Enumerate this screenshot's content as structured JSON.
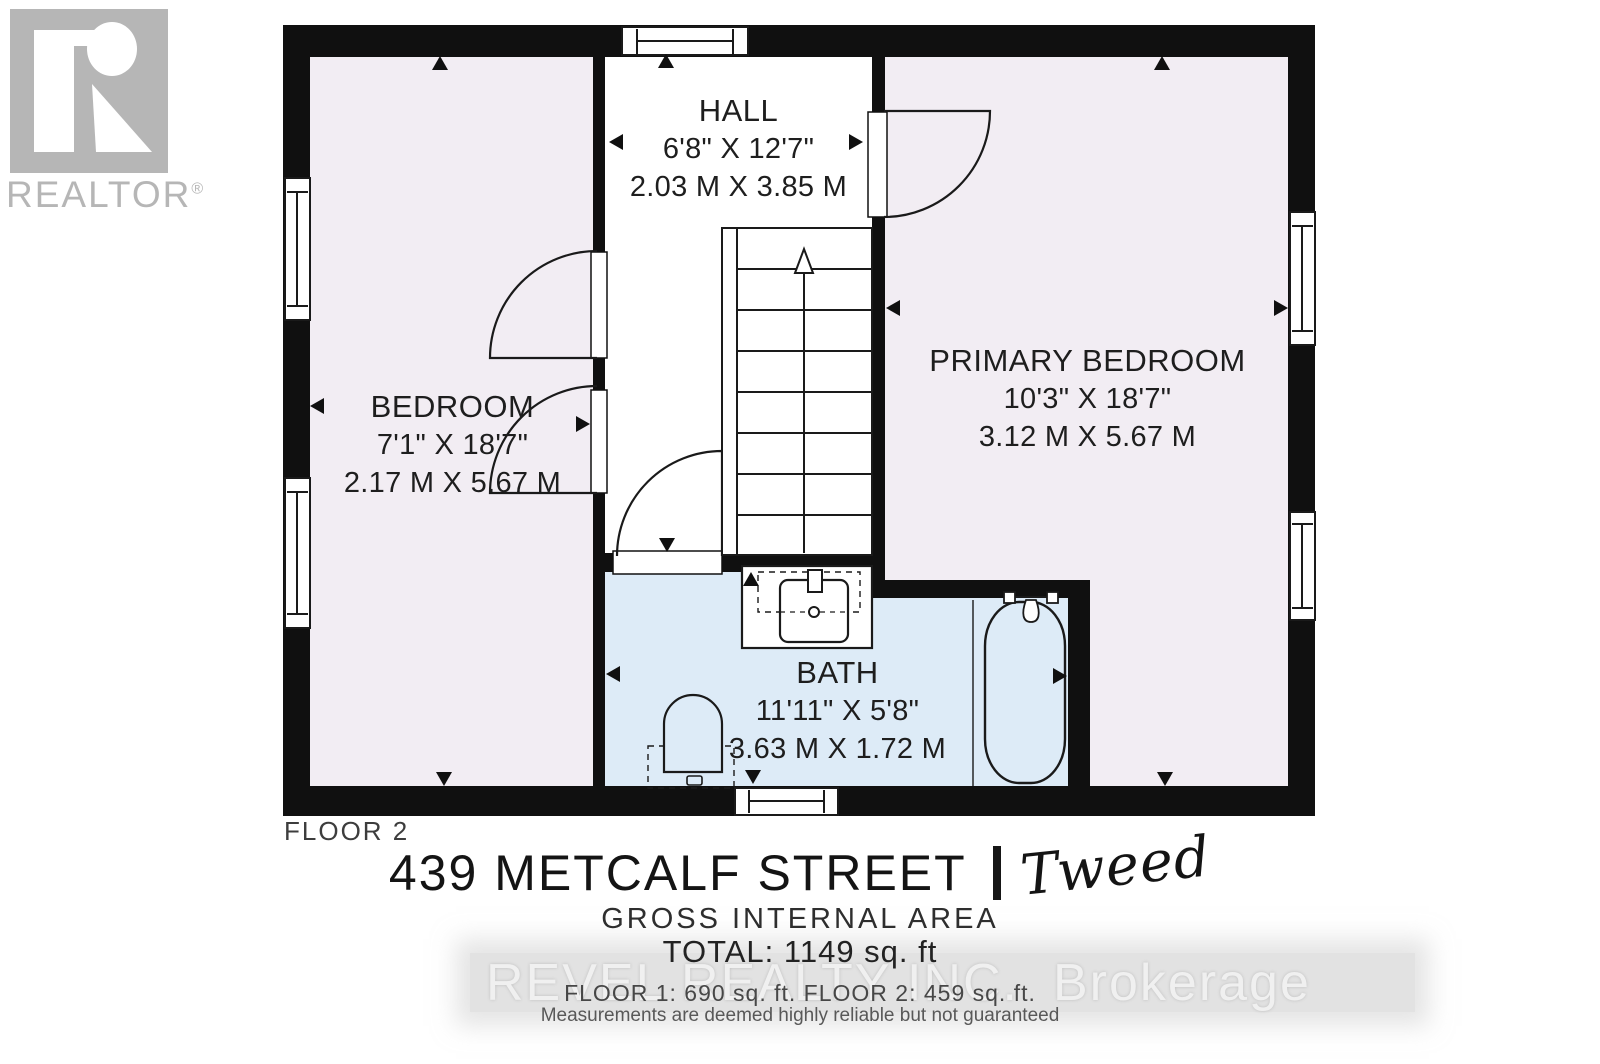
{
  "logo": {
    "text": "REALTOR",
    "reg": "®"
  },
  "plan": {
    "floor_label": "FLOOR 2"
  },
  "rooms": [
    {
      "id": "hall",
      "name": "HALL",
      "imperial": "6'8\" X 12'7\"",
      "metric": "2.03 M X 3.85 M"
    },
    {
      "id": "bedroom",
      "name": "BEDROOM",
      "imperial": "7'1\" X 18'7\"",
      "metric": "2.17 M X 5.67 M"
    },
    {
      "id": "primary-bedroom",
      "name": "PRIMARY BEDROOM",
      "imperial": "10'3\" X 18'7\"",
      "metric": "3.12 M X 5.67 M"
    },
    {
      "id": "bath",
      "name": "BATH",
      "imperial": "11'11\" X 5'8\"",
      "metric": "3.63 M X 1.72 M"
    }
  ],
  "footer": {
    "address": "439 METCALF STREET",
    "separator": "|",
    "town": "Tweed",
    "gross_internal_area_label": "GROSS INTERNAL AREA",
    "total": "TOTAL: 1149 sq. ft",
    "floor_areas": "FLOOR 1: 690 sq. ft. FLOOR 2: 459 sq. ft.",
    "disclaimer": "Measurements are deemed highly reliable but not guaranteed"
  },
  "watermark": {
    "brand": "REVEL REALTY INC.",
    "suffix": "Brokerage"
  },
  "colors": {
    "room_fill": "#f2edf3",
    "bath_fill": "#ddebf7",
    "wall": "#101010",
    "logo_gray": "#b6b6b6",
    "label_text": "#1e1e1e"
  }
}
